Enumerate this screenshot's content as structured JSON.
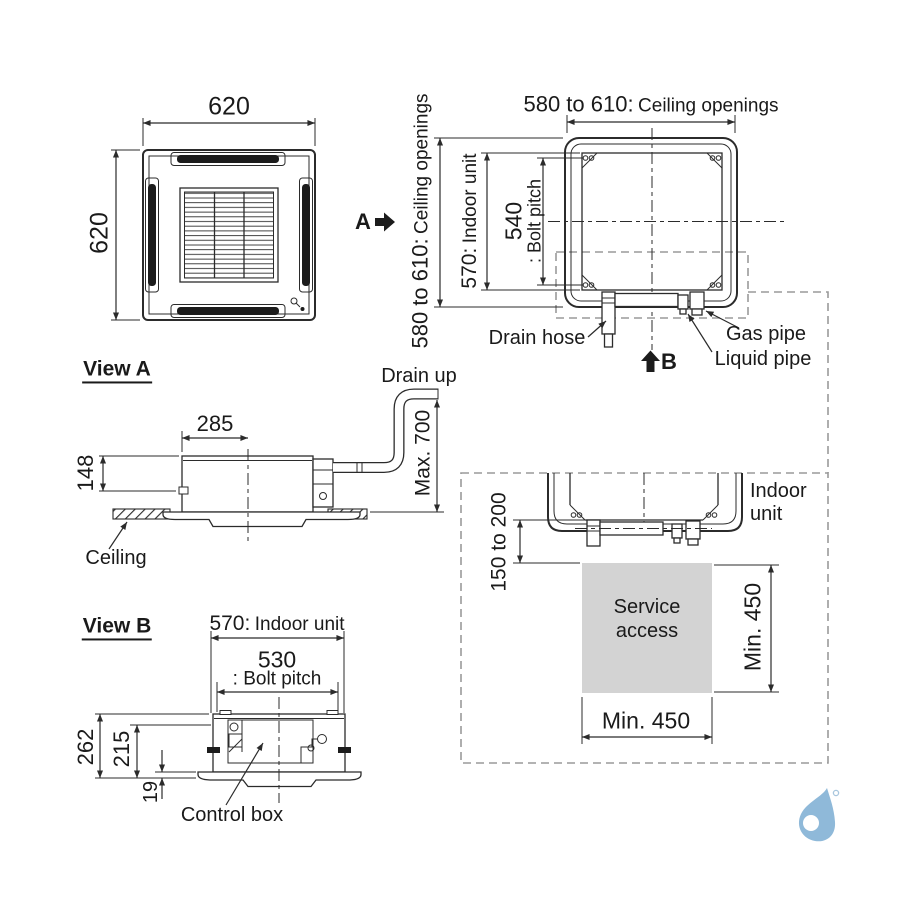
{
  "colors": {
    "line": "#2b2b2b",
    "dashed_zone": "#9a9a9a",
    "service_fill": "#d3d3d3",
    "logo_blue": "#8fb9d9"
  },
  "top_view": {
    "width_dim": "620",
    "height_dim": "620",
    "view_a_label": "A"
  },
  "ceiling_plan": {
    "top_dim_value": "580 to 610:",
    "top_dim_label": "Ceiling openings",
    "left_dim_value": "580 to 610:",
    "left_dim_label": "Ceiling openings",
    "unit_dim_value": "570:",
    "unit_dim_label": "Indoor unit",
    "bolt_dim_value": "540",
    "bolt_dim_label": ": Bolt pitch",
    "drain_hose_label": "Drain hose",
    "gas_pipe_label": "Gas pipe",
    "liquid_pipe_label": "Liquid pipe",
    "view_b_label": "B"
  },
  "view_a": {
    "title": "View A",
    "drain_up_label": "Drain up",
    "width_dim": "285",
    "height_dim": "148",
    "drain_lift_dim": "Max. 700",
    "ceiling_label": "Ceiling"
  },
  "view_b": {
    "title": "View B",
    "unit_dim_value": "570:",
    "unit_dim_label": "Indoor unit",
    "bolt_dim_value": "530",
    "bolt_dim_label": ": Bolt pitch",
    "total_height_dim": "262",
    "body_height_dim": "215",
    "panel_height_dim": "19",
    "control_box_label": "Control box"
  },
  "service_clearance": {
    "indoor_unit_label": "Indoor unit",
    "top_gap_dim": "150 to 200",
    "service_access_label": "Service access",
    "right_dim": "Min. 450",
    "bottom_dim": "Min. 450"
  }
}
